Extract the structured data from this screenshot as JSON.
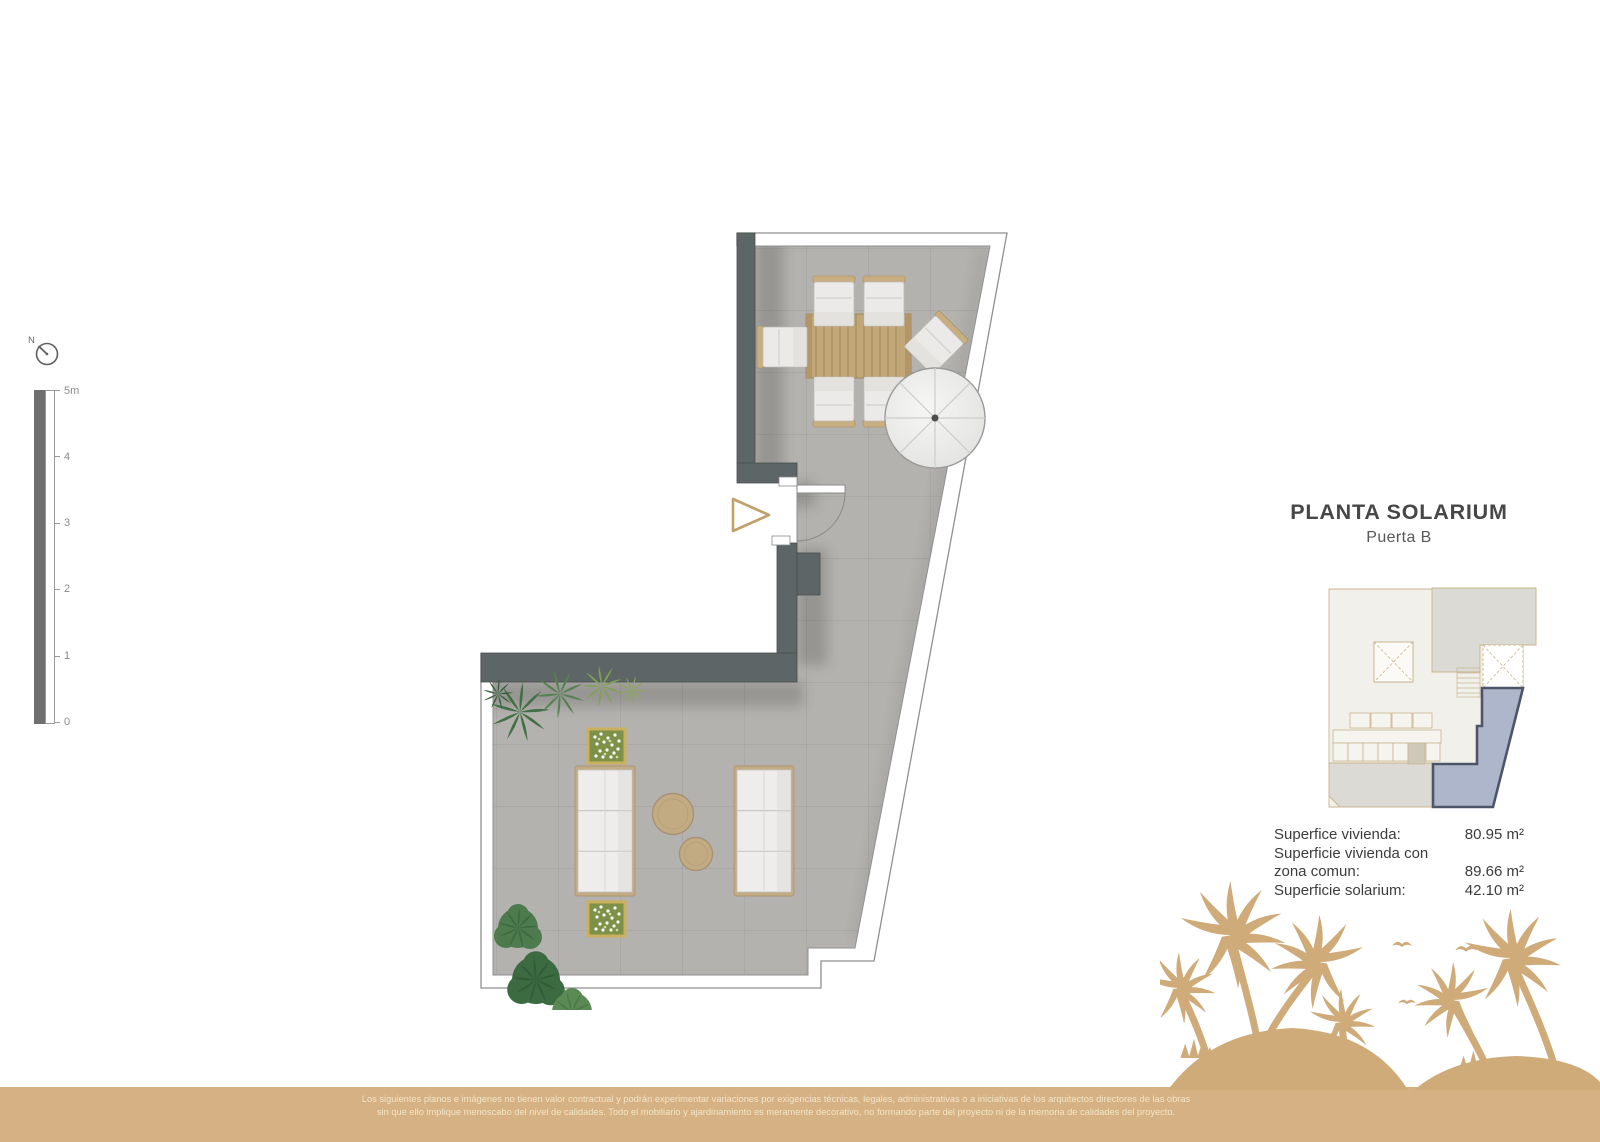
{
  "header": {
    "title": "PLANTA SOLARIUM",
    "subtitle": "Puerta B"
  },
  "areas": {
    "rows": [
      {
        "label": "Superfice vivienda:",
        "value": "80.95 m²"
      },
      {
        "label": "Superficie vivienda con\nzona comun:",
        "value": "89.66 m²"
      },
      {
        "label": "Superficie solarium:",
        "value": "42.10 m²"
      }
    ]
  },
  "north": {
    "label": "N"
  },
  "scalebar": {
    "labels": [
      "5m",
      "4",
      "3",
      "2",
      "1",
      "0"
    ]
  },
  "footer": {
    "line1": "Los siguientes planos e imágenes no tienen valor contractual y podrán experimentar variaciones por exigencias técnicas, legales, administrativas o a iniciativas de los arquitectos directores de las obras",
    "line2": "sin que ello implique menoscabo del nivel de calidades. Todo el mobiliario y ajardinamiento es meramente decorativo, no formando parte del proyecto ni de la memoria de calidades del proyecto."
  },
  "colors": {
    "accent_tan": "#d5b184",
    "palm_tan": "#d0ab7a",
    "wall_gray": "#5d6566",
    "floor_gray": "#b4b2af",
    "unit_highlight_fill": "#aeb6cb",
    "unit_highlight_stroke": "#4d5668"
  }
}
